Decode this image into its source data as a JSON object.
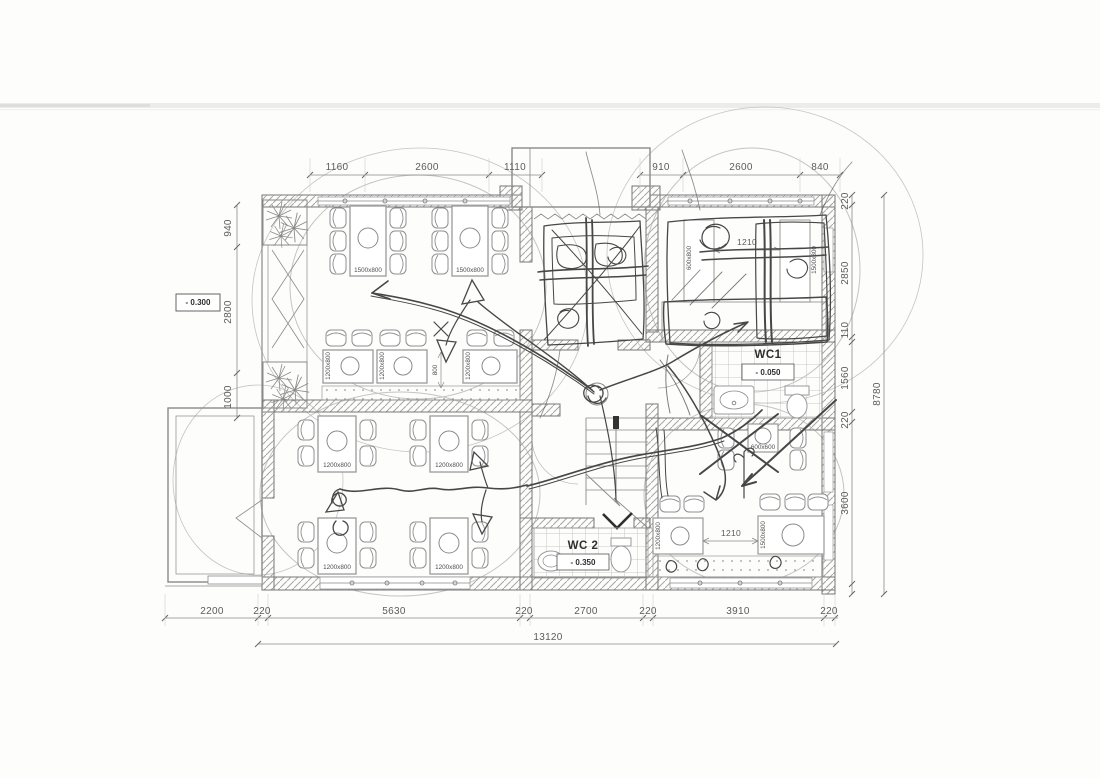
{
  "drawing": {
    "dims": {
      "top": [
        "1160",
        "2600",
        "1110",
        "910",
        "2600",
        "840"
      ],
      "left": [
        "940",
        "2800",
        "1000"
      ],
      "right": [
        "220",
        "2850",
        "110",
        "1560",
        "220",
        "3600"
      ],
      "right_total": "8780",
      "bottom": [
        "2200",
        "220",
        "5630",
        "220",
        "2700",
        "220",
        "3910",
        "220"
      ],
      "bottom_total": "13120",
      "upper_right_gap": "1210",
      "lower_right_gap": "1210",
      "mid_gap": "800"
    },
    "levels": {
      "entry": "- 0.300",
      "wc1": "- 0.050",
      "wc2": "- 0.350"
    },
    "rooms": {
      "wc1": "WC1",
      "wc2": "WC 2"
    },
    "tables": {
      "t1500": "1500x800",
      "t1200": "1200x800",
      "t600": "600x600",
      "t600_800": "600x800"
    },
    "colors": {
      "paper": "#fdfdfc",
      "cad_line": "#8a8a8a",
      "wall_edge": "#777777",
      "dim_text": "#5c5c5c",
      "pencil": "#474747"
    }
  }
}
